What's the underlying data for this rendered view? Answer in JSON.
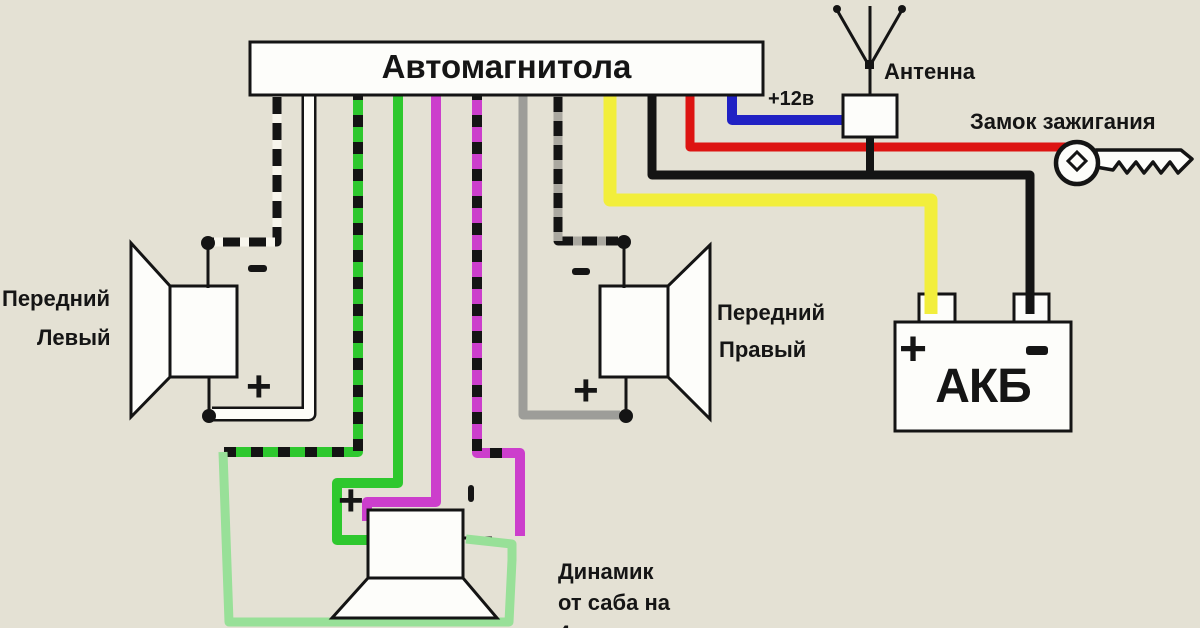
{
  "head_unit": {
    "label": "Автомагнитола"
  },
  "antenna": {
    "label": "Антенна"
  },
  "power": {
    "plus12": "+12в"
  },
  "ignition": {
    "label": "Замок зажигания"
  },
  "battery": {
    "label": "АКБ",
    "plus": "+",
    "minus": "-"
  },
  "front_left_speaker": {
    "line1": "Передний",
    "line2": "Левый",
    "plus": "+",
    "minus": "-"
  },
  "front_right_speaker": {
    "line1": "Передний",
    "line2": "Правый",
    "plus": "+",
    "minus": "-"
  },
  "sub_speaker": {
    "plus": "+",
    "caption_line1": "Динамик",
    "caption_line2": "от саба на",
    "caption_line3": "4 ома"
  },
  "colors": {
    "background": "#e4e1d4",
    "outline": "#141414",
    "box_fill": "#fdfdfa",
    "yellow": "#f2ee3c",
    "red": "#dd1412",
    "blue": "#2021c4",
    "green": "#2ec82e",
    "pale_green": "#98e098",
    "magenta": "#cc3ecc",
    "gray": "#9d9d99",
    "white_dash": "#f7f5ec"
  },
  "wires": [
    {
      "name": "front-left-minus-wire",
      "color": "#141414",
      "width": 9,
      "overlay": {
        "color": "#f7f5ec",
        "dash": "9 17"
      },
      "points": [
        [
          277,
          88
        ],
        [
          277,
          242
        ],
        [
          212,
          242
        ]
      ]
    },
    {
      "name": "front-left-plus-wire",
      "color": "#141414",
      "width": 15,
      "overlay": {
        "color": "#fdfdf8",
        "width": 10
      },
      "points": [
        [
          309,
          88
        ],
        [
          309,
          414
        ],
        [
          212,
          414
        ]
      ]
    },
    {
      "name": "sub-rear-left-striped-wire",
      "color": "#2ec82e",
      "width": 10,
      "overlay": {
        "color": "#141414",
        "dash": "12 15"
      },
      "points": [
        [
          358,
          88
        ],
        [
          358,
          452
        ],
        [
          224,
          452
        ]
      ]
    },
    {
      "name": "sub-connector-line",
      "color": "#141414",
      "width": 3,
      "points": [
        [
          461,
          538
        ],
        [
          492,
          538
        ]
      ]
    },
    {
      "name": "sub-jumper-pale-green-wire",
      "color": "#98e098",
      "width": 9,
      "points": [
        [
          223,
          452
        ],
        [
          229,
          622
        ],
        [
          509,
          622
        ],
        [
          512,
          560
        ],
        [
          512,
          544
        ],
        [
          466,
          539
        ]
      ]
    },
    {
      "name": "sub-rear-left-green-wire",
      "color": "#2ec82e",
      "width": 10,
      "points": [
        [
          398,
          88
        ],
        [
          398,
          483
        ],
        [
          337,
          483
        ],
        [
          337,
          540
        ],
        [
          371,
          540
        ]
      ]
    },
    {
      "name": "sub-rear-right-magenta-wire",
      "color": "#cc3ecc",
      "width": 10,
      "points": [
        [
          436,
          88
        ],
        [
          436,
          502
        ],
        [
          367,
          502
        ],
        [
          367,
          521
        ]
      ]
    },
    {
      "name": "sub-rear-right-striped-wire",
      "color": "#cc3ecc",
      "width": 10,
      "overlay": {
        "color": "#141414",
        "dash": "12 15"
      },
      "points": [
        [
          477,
          88
        ],
        [
          477,
          453
        ],
        [
          512,
          453
        ]
      ]
    },
    {
      "name": "sub-rear-right-striped-wire-drop",
      "color": "#cc3ecc",
      "width": 10,
      "points": [
        [
          508,
          453
        ],
        [
          520,
          453
        ],
        [
          520,
          536
        ]
      ]
    },
    {
      "name": "front-right-plus-wire",
      "color": "#9d9d99",
      "width": 9,
      "points": [
        [
          523,
          88
        ],
        [
          523,
          415
        ],
        [
          620,
          415
        ]
      ]
    },
    {
      "name": "front-right-minus-wire",
      "color": "#141414",
      "width": 9,
      "overlay": {
        "color": "#aaa8a0",
        "dash": "9 15"
      },
      "points": [
        [
          558,
          88
        ],
        [
          558,
          241
        ],
        [
          618,
          241
        ]
      ]
    },
    {
      "name": "battery-plus-yellow-wire",
      "color": "#f2ee3c",
      "width": 13,
      "points": [
        [
          610,
          88
        ],
        [
          610,
          200
        ],
        [
          931,
          200
        ],
        [
          931,
          292
        ]
      ]
    },
    {
      "name": "battery-minus-black-wire",
      "color": "#141414",
      "width": 9,
      "points": [
        [
          652,
          88
        ],
        [
          652,
          175
        ],
        [
          1030,
          175
        ],
        [
          1030,
          292
        ]
      ]
    },
    {
      "name": "ignition-red-wire",
      "color": "#dd1412",
      "width": 9,
      "points": [
        [
          690,
          88
        ],
        [
          690,
          147
        ],
        [
          1078,
          147
        ]
      ]
    },
    {
      "name": "antenna-blue-wire",
      "color": "#2021c4",
      "width": 10,
      "points": [
        [
          732,
          88
        ],
        [
          732,
          120
        ],
        [
          846,
          120
        ]
      ]
    },
    {
      "name": "antenna-ground-stub",
      "color": "#141414",
      "width": 8,
      "points": [
        [
          870,
          133
        ],
        [
          870,
          176
        ]
      ]
    }
  ],
  "wires_top": [
    {
      "name": "battery-plus-wire-end",
      "color": "#f2ee3c",
      "width": 13,
      "points": [
        [
          931,
          288
        ],
        [
          931,
          314
        ]
      ]
    },
    {
      "name": "battery-minus-wire-end",
      "color": "#141414",
      "width": 9,
      "points": [
        [
          1030,
          288
        ],
        [
          1030,
          314
        ]
      ]
    }
  ]
}
